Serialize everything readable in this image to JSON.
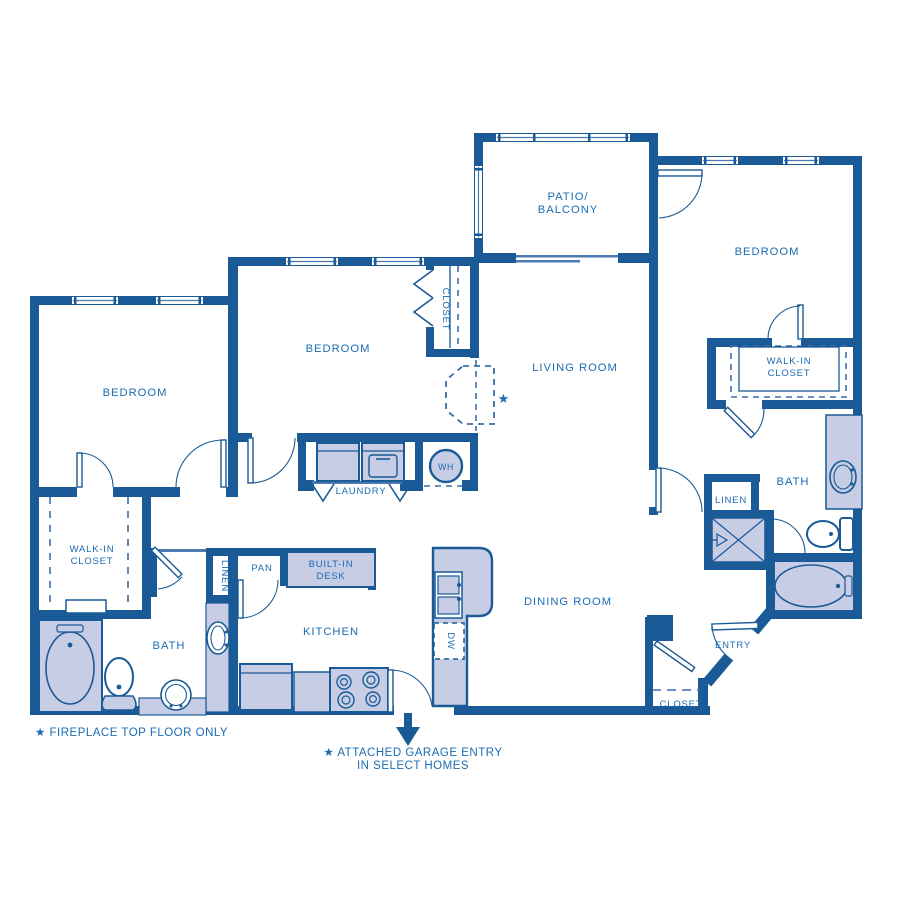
{
  "plan": {
    "title_hint": "apartment floor plan",
    "rooms": {
      "patio_line1": "PATIO/",
      "patio_line2": "BALCONY",
      "bedroom": "BEDROOM",
      "living_room": "LIVING ROOM",
      "dining_room": "DINING ROOM",
      "kitchen": "KITCHEN",
      "laundry": "LAUNDRY",
      "bath": "BATH",
      "entry": "ENTRY",
      "closet": "CLOSET",
      "linen": "LINEN",
      "pantry": "PAN",
      "walk_in_line1": "WALK-IN",
      "walk_in_line2": "CLOSET",
      "desk_line1": "BUILT-IN",
      "desk_line2": "DESK",
      "water_heater": "WH",
      "dishwasher": "DW"
    },
    "markers": {
      "fireplace_star": "★"
    },
    "notes": {
      "fireplace": "★ FIREPLACE TOP FLOOR ONLY",
      "garage_line1": "★ ATTACHED GARAGE ENTRY",
      "garage_line2": "IN SELECT HOMES"
    },
    "colors": {
      "wall": "#1a5a96",
      "fixture_fill": "#c6cde5",
      "text": "#1b6cb2",
      "thin_line": "#4a7ab0",
      "background": "#ffffff"
    }
  }
}
